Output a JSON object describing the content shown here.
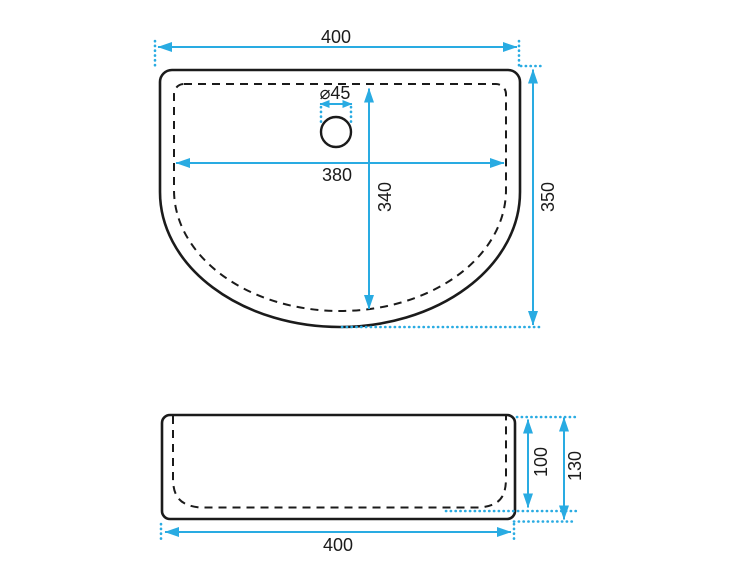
{
  "colors": {
    "accent": "#29abe2",
    "ink": "#1b1b1b",
    "background": "#ffffff"
  },
  "top_view": {
    "dim_overall_width": "400",
    "dim_overall_depth": "350",
    "dim_inner_width": "380",
    "dim_inner_depth": "340",
    "dim_drain_diameter": "⌀45"
  },
  "front_view": {
    "dim_overall_width": "400",
    "dim_overall_height": "130",
    "dim_bowl_depth": "100"
  }
}
